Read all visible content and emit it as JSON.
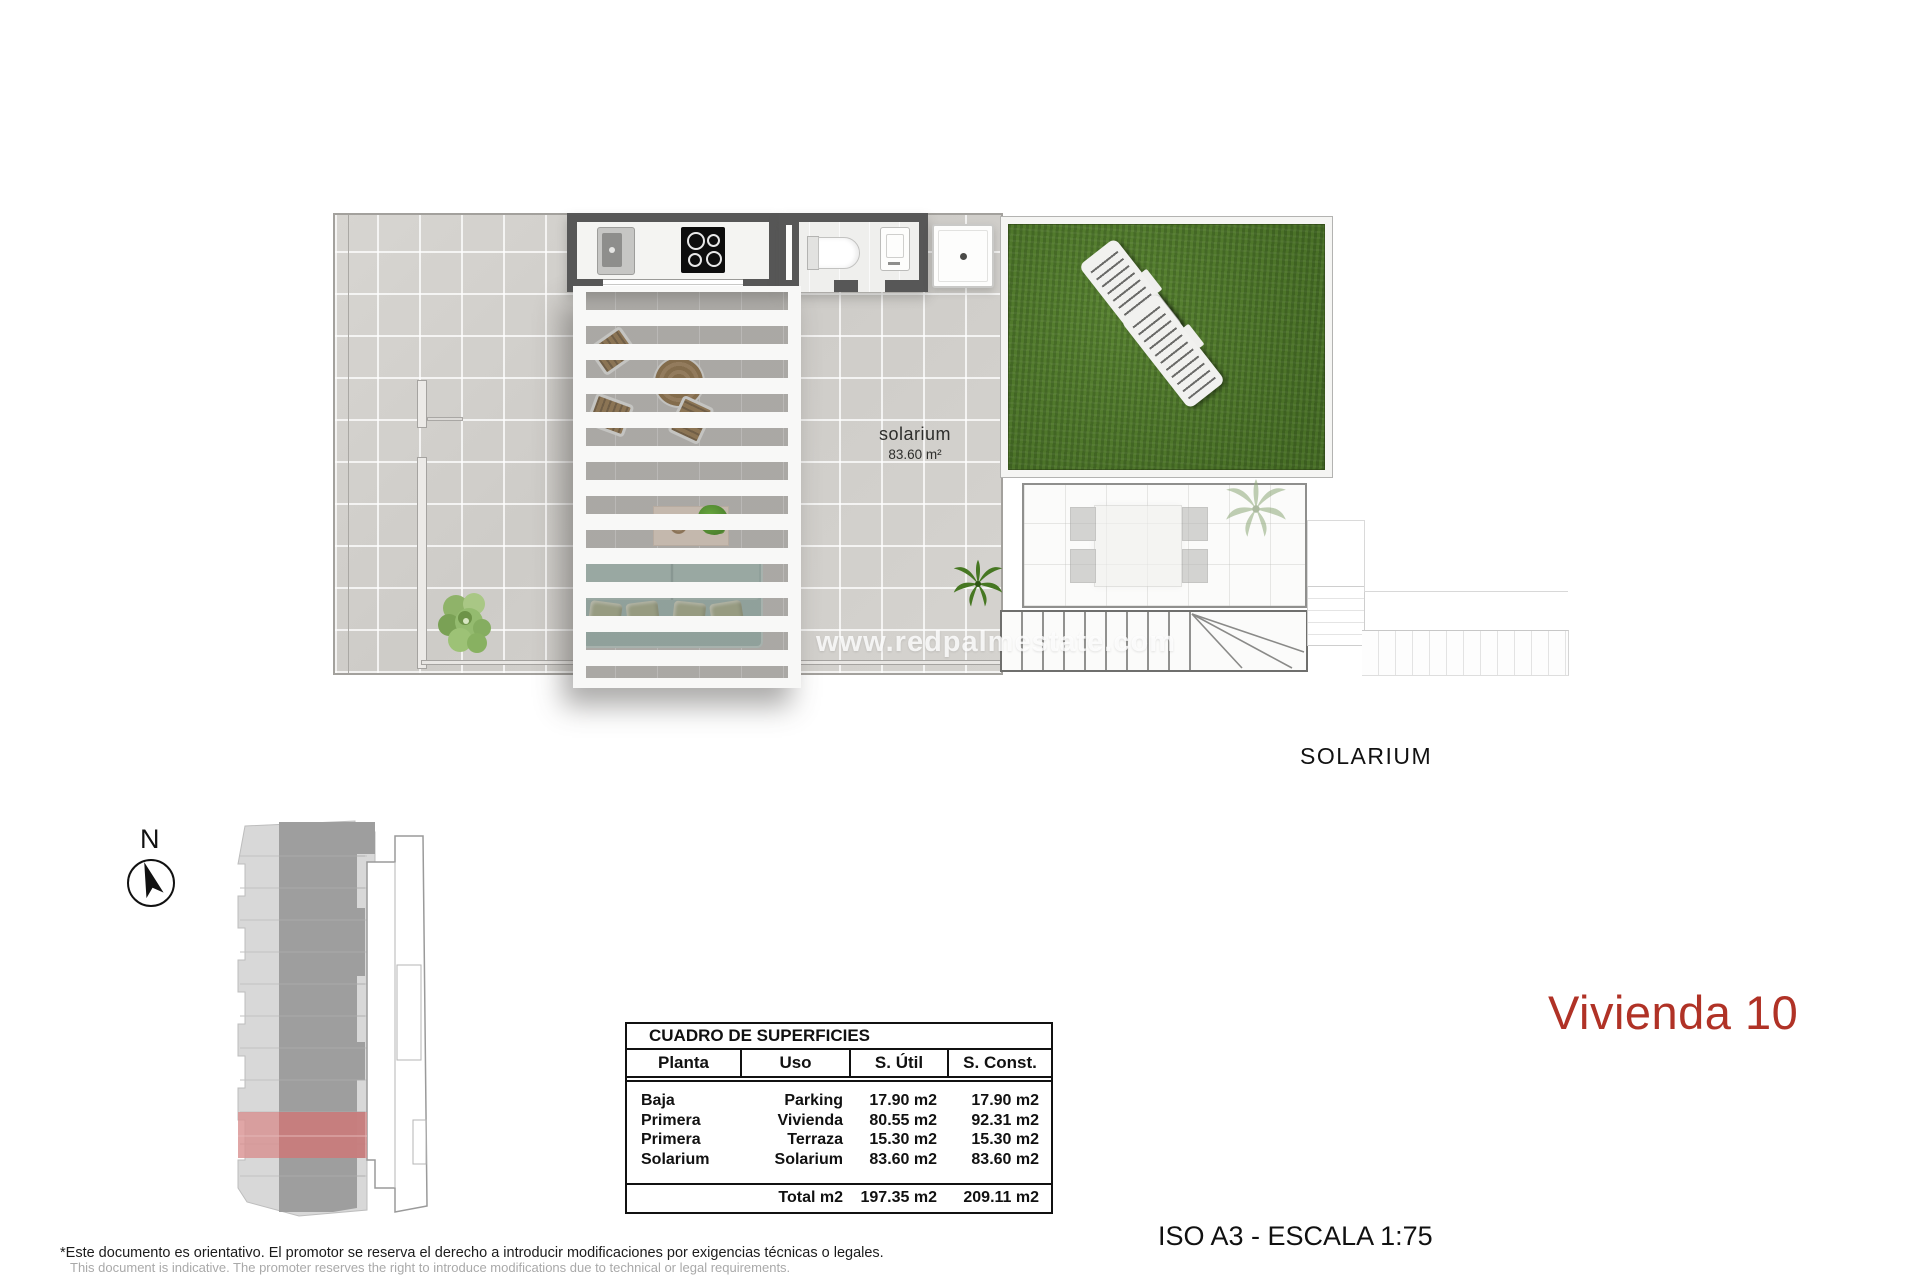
{
  "page": {
    "watermark": "www.redpalmestate.com",
    "caption": "SOLARIUM",
    "unit_title": "Vivienda 10",
    "scale_note": "ISO A3 - ESCALA 1:75",
    "disclaimer_es": "*Este documento es orientativo. El promotor se reserva el derecho a introducir modificaciones por exigencias técnicas o legales.",
    "disclaimer_en": "This document is indicative. The promoter reserves the right to introduce modifications due to technical or legal requirements.",
    "compass_label": "N"
  },
  "floor_plan": {
    "room_label": "solarium",
    "room_area": "83.60 m²"
  },
  "surfaces_table": {
    "title": "CUADRO DE SUPERFICIES",
    "headers": [
      "Planta",
      "Uso",
      "S. Útil",
      "S. Const."
    ],
    "rows": [
      [
        "Baja",
        "Parking",
        "17.90 m2",
        "17.90 m2"
      ],
      [
        "Primera",
        "Vivienda",
        "80.55 m2",
        "92.31 m2"
      ],
      [
        "Primera",
        "Terraza",
        "15.30 m2",
        "15.30 m2"
      ],
      [
        "Solarium",
        "Solarium",
        "83.60 m2",
        "83.60 m2"
      ]
    ],
    "total": [
      "",
      "Total m2",
      "197.35 m2",
      "209.11 m2"
    ]
  },
  "colors": {
    "accent_red": "#b03226",
    "grass_green": "#4e7a2c",
    "site_highlight": "#d28c8c"
  }
}
